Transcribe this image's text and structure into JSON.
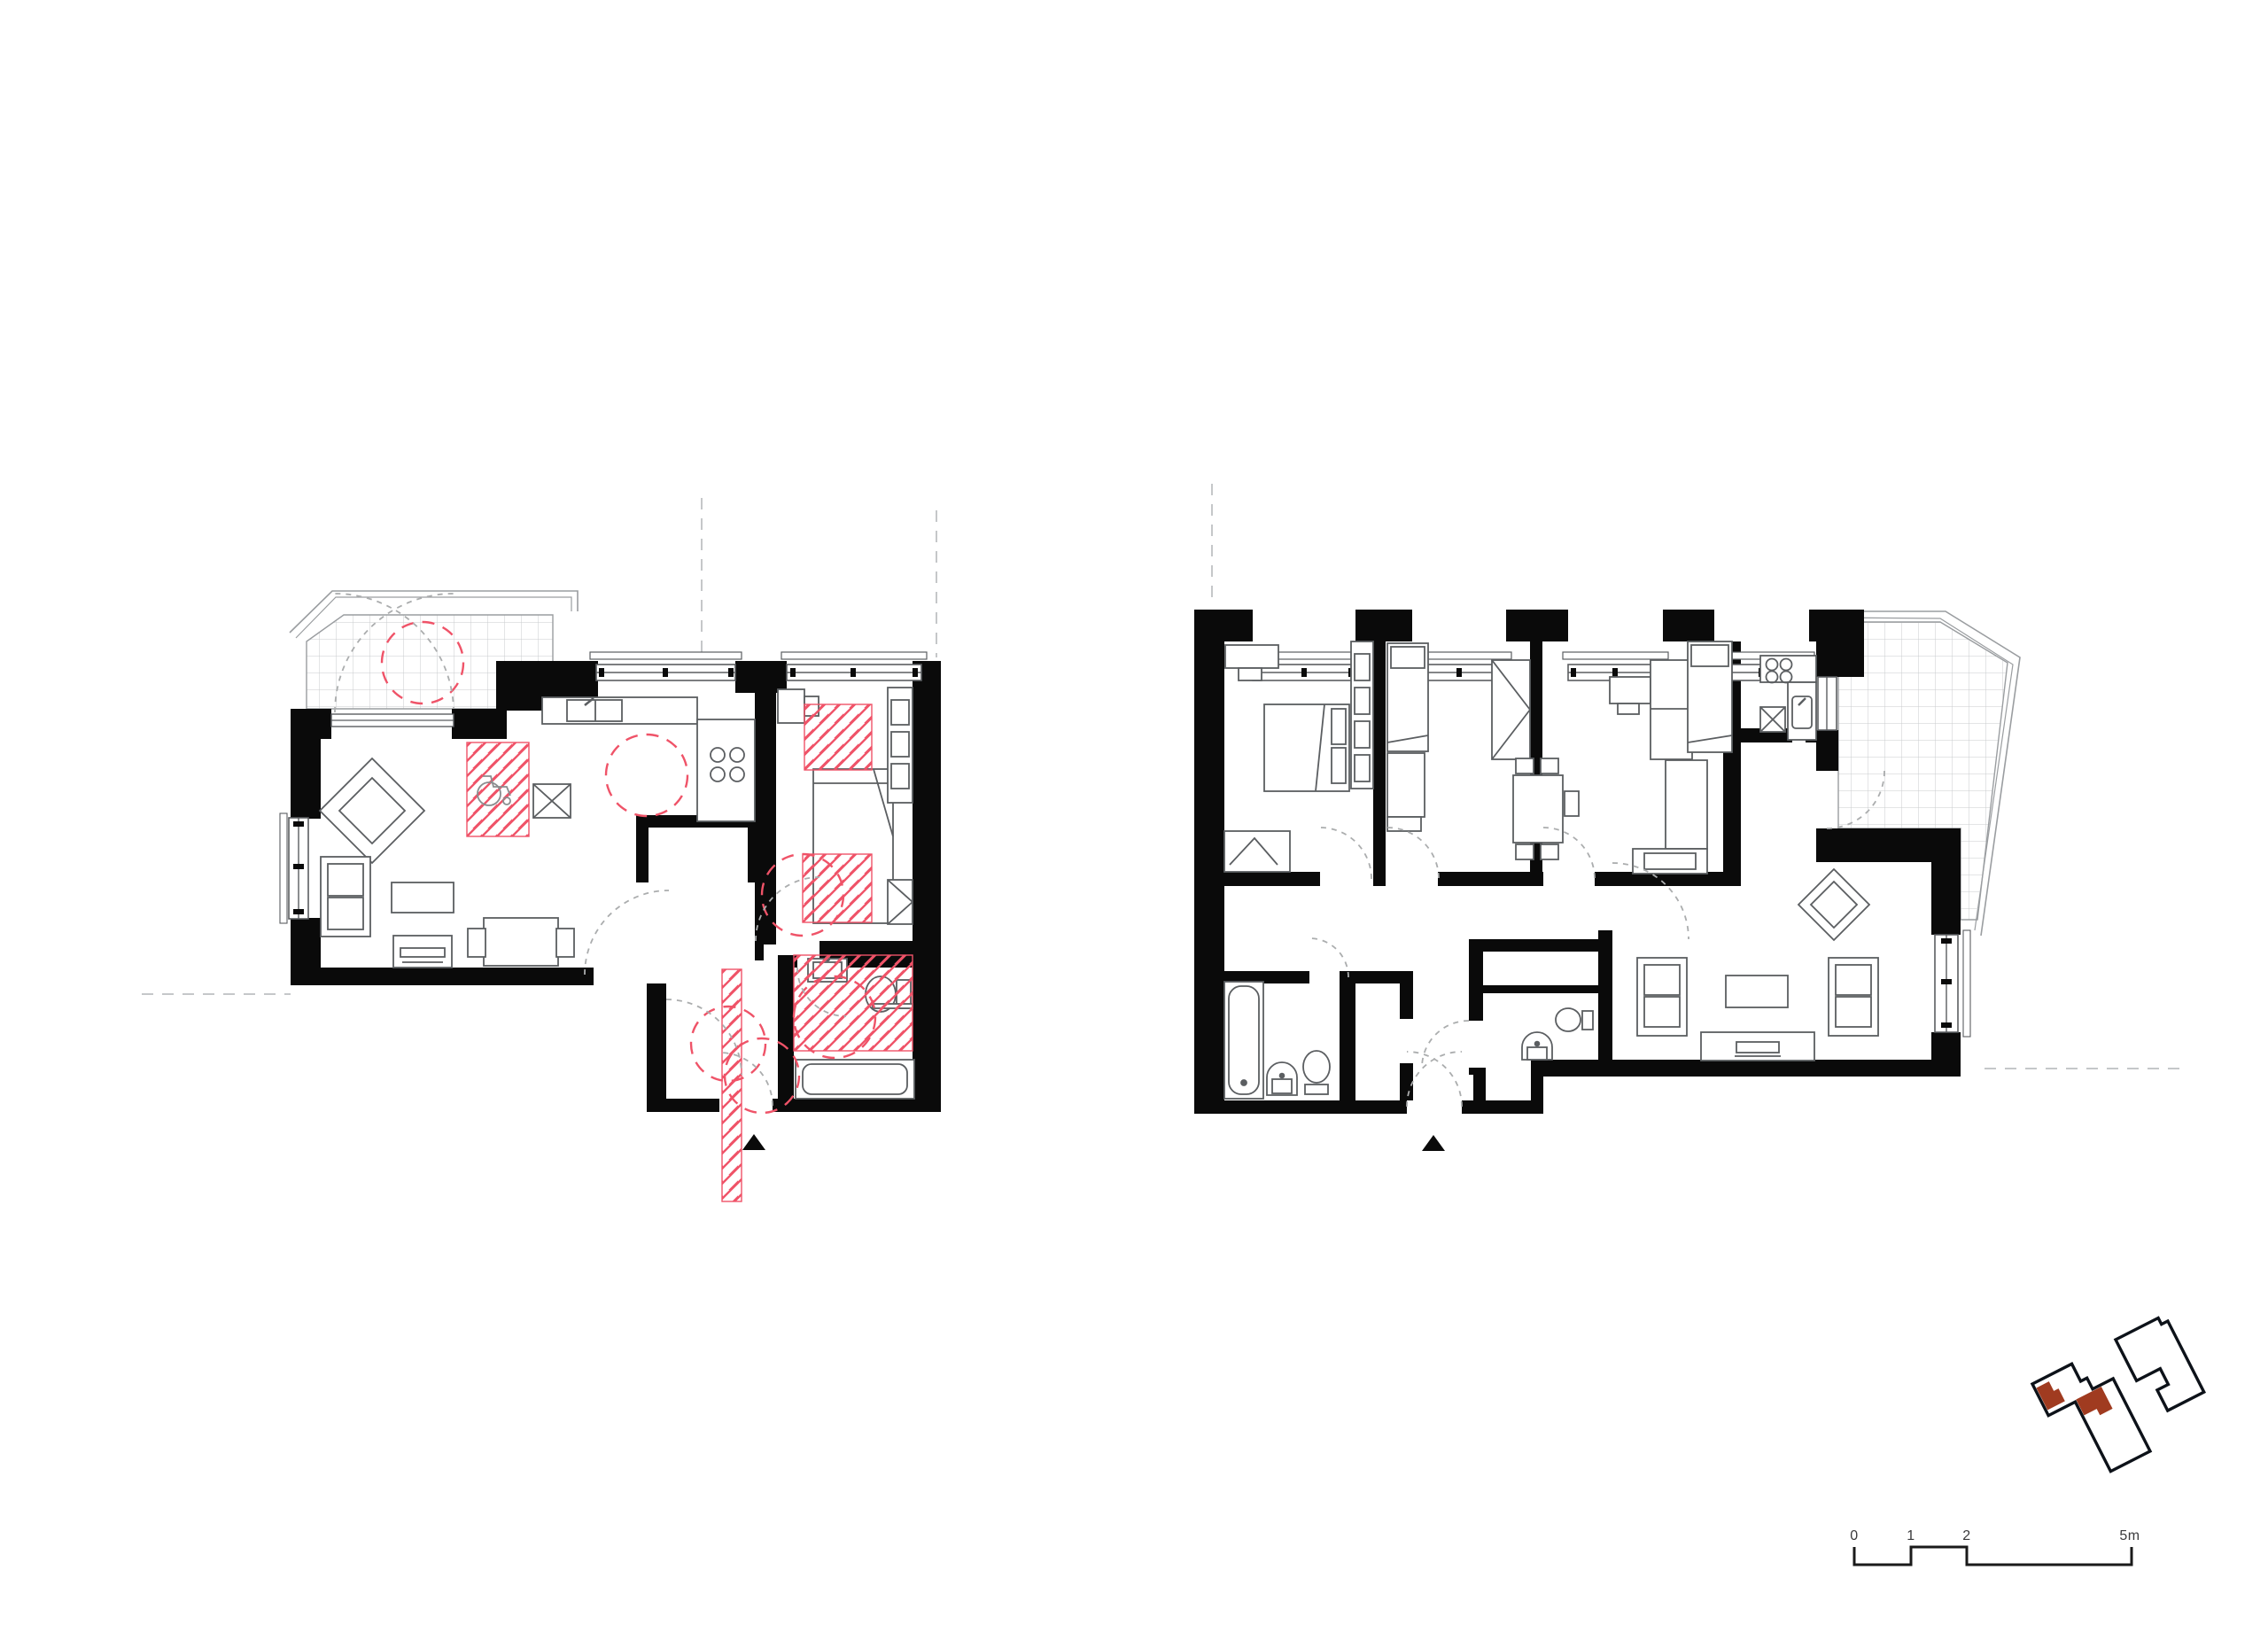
{
  "sheet": {
    "kind": "architectural floor plan drawing",
    "background": "#ffffff"
  },
  "scale_bar": {
    "labels": [
      "0",
      "1",
      "2",
      "5m"
    ]
  },
  "colors": {
    "walls": "#0a0a0a",
    "furniture_line": "#5b5e61",
    "accessibility_pink": "#ef5368",
    "door_swing_gray": "#abadae",
    "tile_grid_gray": "#c8cbcd",
    "reference_dash_gray": "#c5c7c9",
    "site_outline": "#0d1219",
    "site_highlight_red": "#a03b20",
    "scale_text": "#3a3a3c"
  },
  "site_plan": {
    "buildings": 2,
    "highlighted_units": 2
  },
  "symbols": {
    "entrance_marker": "filled-triangle",
    "accessibility_zone": "pink-diagonal-hatch",
    "turning_circle": "pink-dashed-circle"
  }
}
